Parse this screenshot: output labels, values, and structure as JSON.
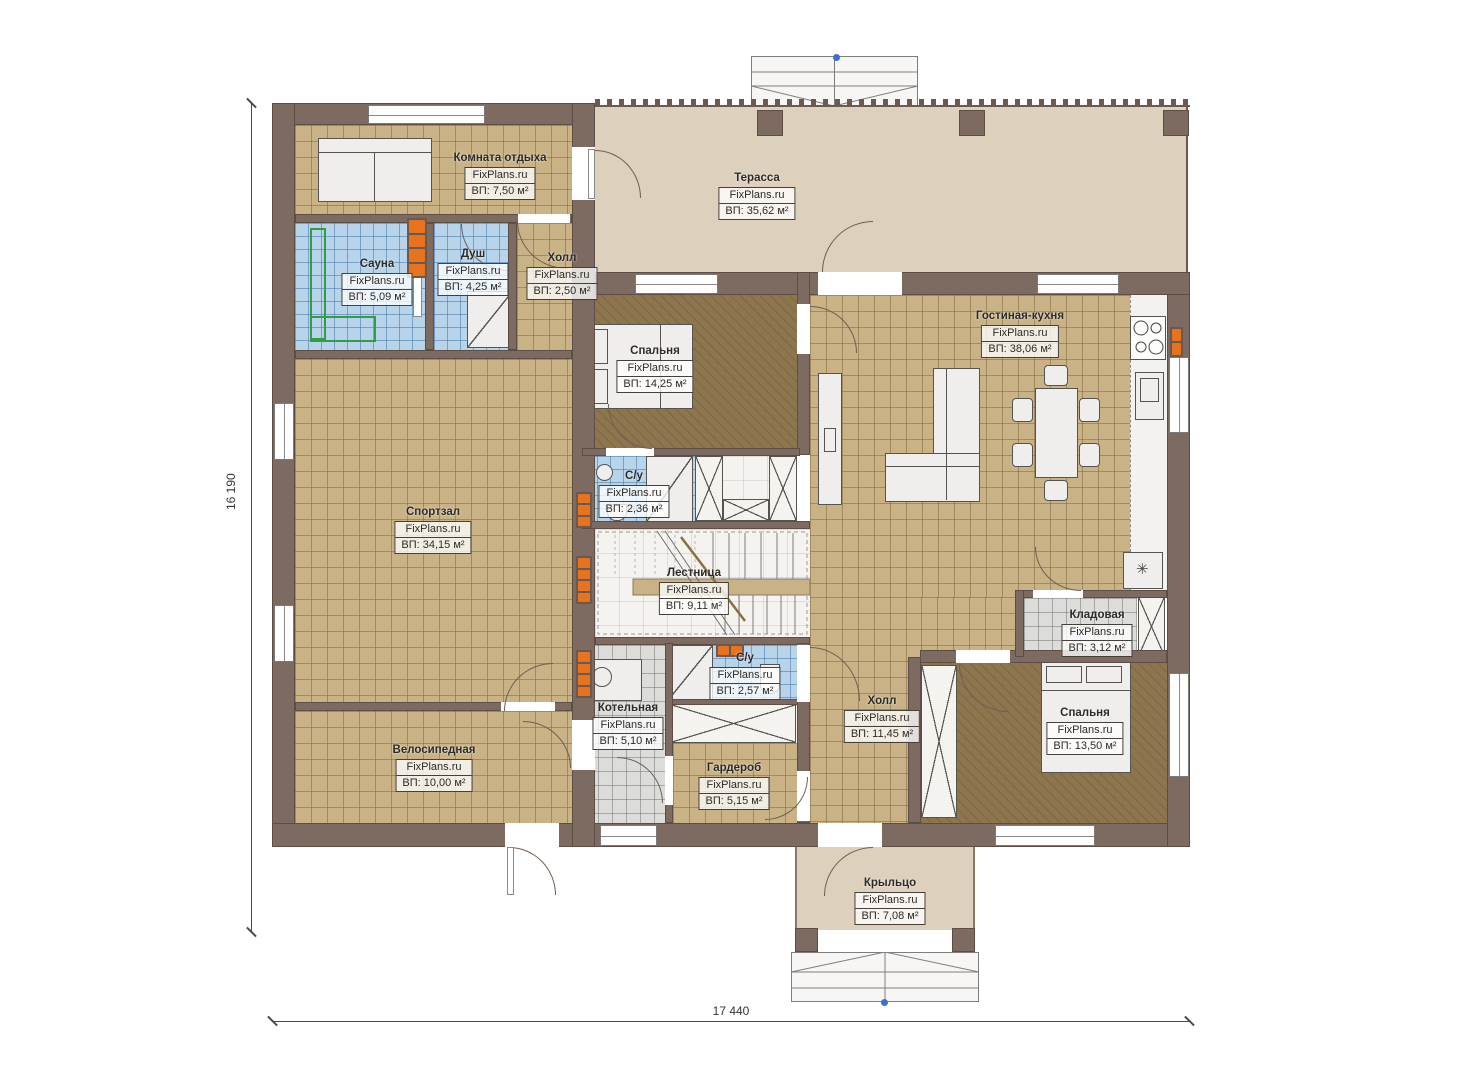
{
  "watermark": "FixPlans.ru",
  "rooms": [
    {
      "name": "Комната отдыха",
      "area": "ВП: 7,50 м²"
    },
    {
      "name": "Терасса",
      "area": "ВП: 35,62 м²"
    },
    {
      "name": "Сауна",
      "area": "ВП: 5,09 м²"
    },
    {
      "name": "Душ",
      "area": "ВП: 4,25 м²"
    },
    {
      "name": "Холл",
      "area": "ВП: 2,50 м²"
    },
    {
      "name": "Спальня",
      "area": "ВП: 14,25 м²"
    },
    {
      "name": "Гостиная-кухня",
      "area": "ВП: 38,06 м²"
    },
    {
      "name": "С/у",
      "area": "ВП: 2,36 м²"
    },
    {
      "name": "Спортзал",
      "area": "ВП: 34,15 м²"
    },
    {
      "name": "Лестница",
      "area": "ВП: 9,11 м²"
    },
    {
      "name": "С/у",
      "area": "ВП: 2,57 м²"
    },
    {
      "name": "Котельная",
      "area": "ВП: 5,10 м²"
    },
    {
      "name": "Холл",
      "area": "ВП: 11,45 м²"
    },
    {
      "name": "Кладовая",
      "area": "ВП: 3,12 м²"
    },
    {
      "name": "Спальня",
      "area": "ВП: 13,50 м²"
    },
    {
      "name": "Велосипедная",
      "area": "ВП: 10,00 м²"
    },
    {
      "name": "Гардероб",
      "area": "ВП: 5,15 м²"
    },
    {
      "name": "Крыльцо",
      "area": "ВП: 7,08 м²"
    }
  ],
  "dimensions": {
    "vertical": "16 190",
    "horizontal": "17 440"
  },
  "symbols": {
    "fridge_snowflake": "✳"
  },
  "colors": {
    "wall": "#7d6a61",
    "floor_tile": "#c9b285",
    "floor_carpet": "#8d754e",
    "floor_wet": "#b7d4ea",
    "floor_service": "#dcdcda",
    "floor_terrace": "#ddd0bc",
    "heater_accent": "#e8731e",
    "sauna_bench": "#2f9e44",
    "axis_marker": "#3a6fd8"
  }
}
